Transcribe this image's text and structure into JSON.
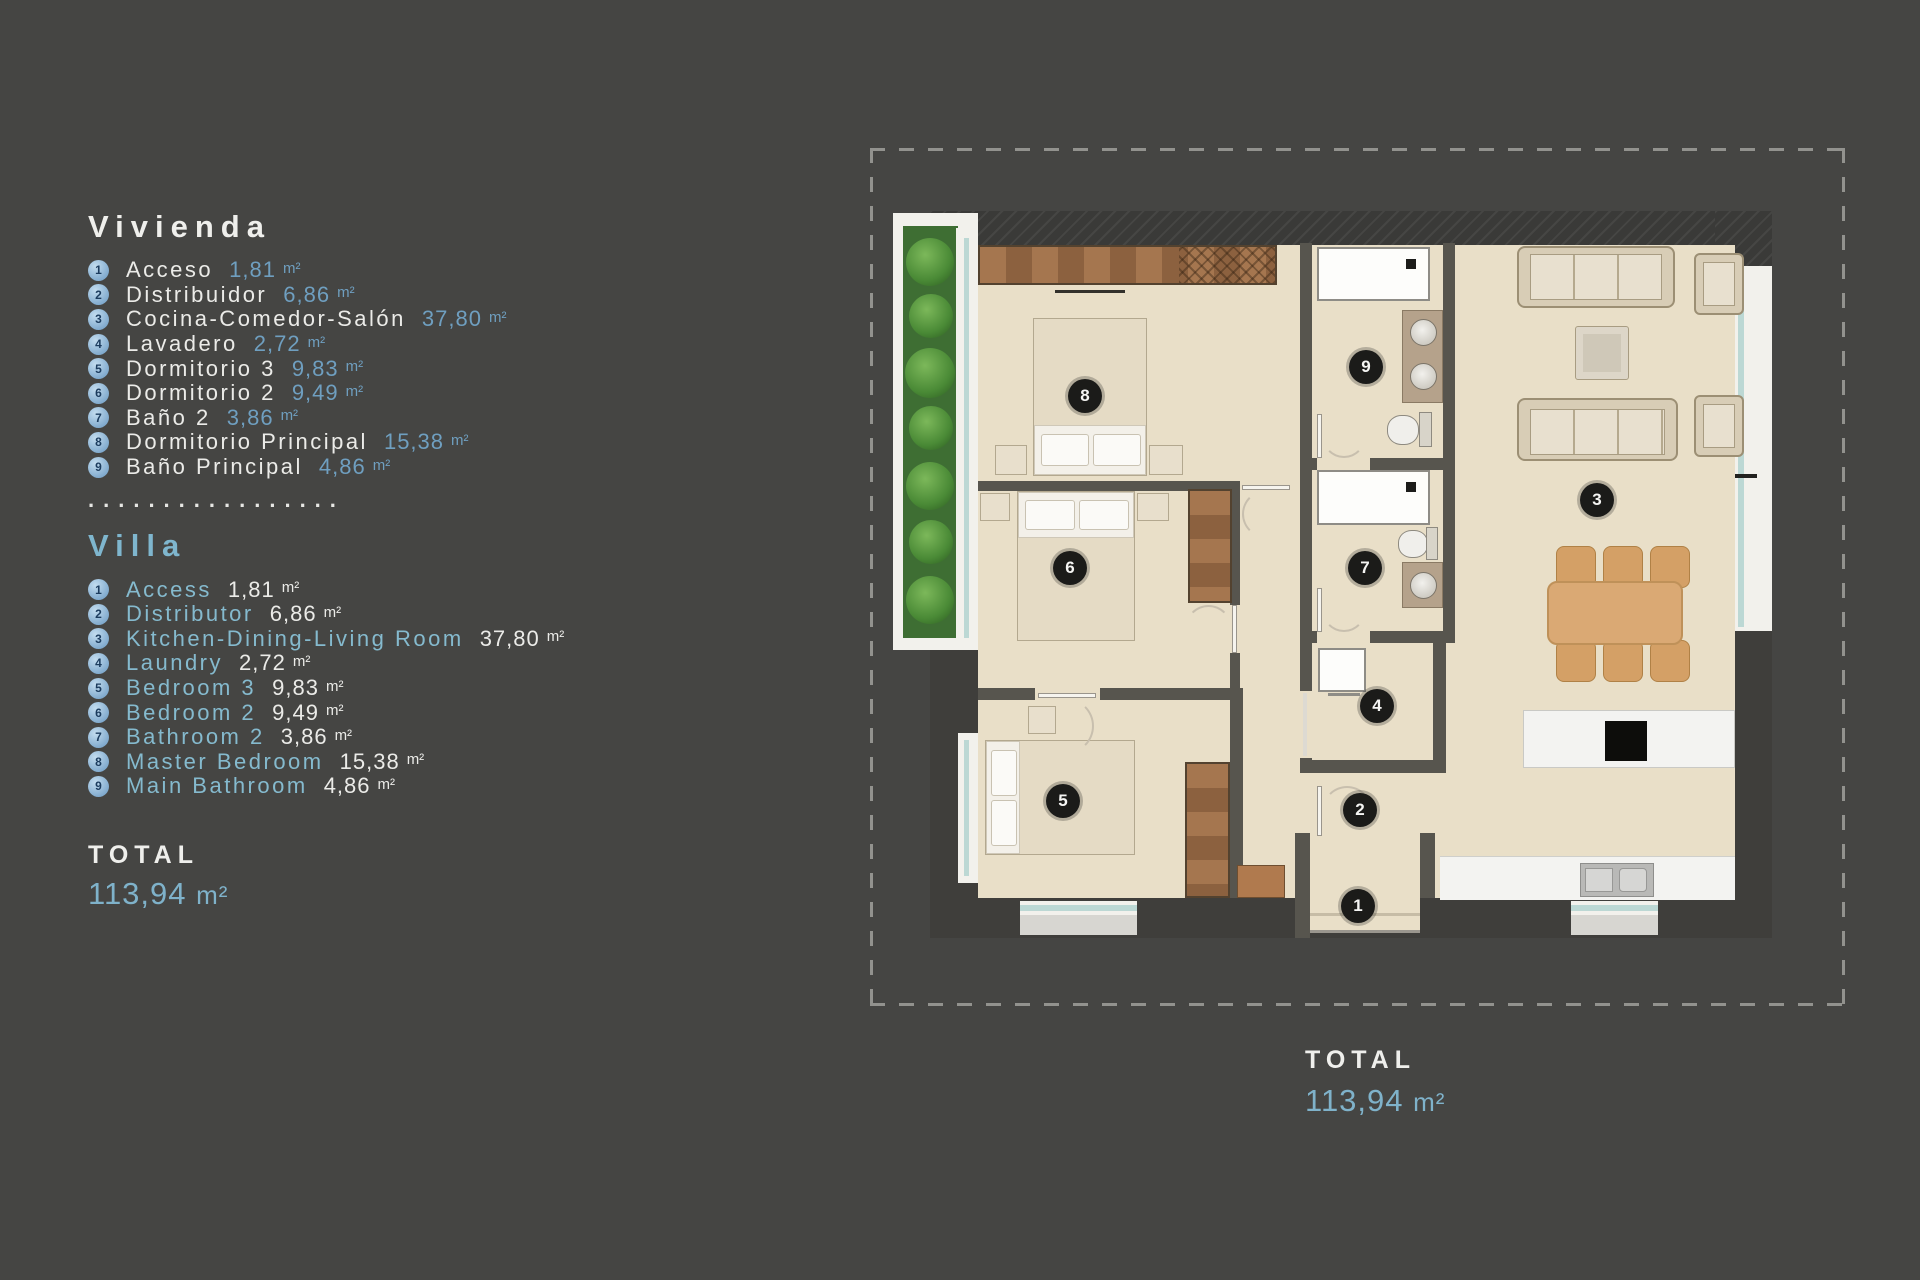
{
  "colors": {
    "background": "#454543",
    "accent_blue_values": "#6f9fc0",
    "accent_blue_villa": "#85bace",
    "total_blue": "#7fb2ca",
    "floor_beige": "#e9dfc8",
    "wall_dark": "#3f3e3b"
  },
  "legend": {
    "vivienda": {
      "title": "Vivienda",
      "items": [
        {
          "num": "1",
          "name": "Acceso",
          "value": "1,81",
          "unit": "m²"
        },
        {
          "num": "2",
          "name": "Distribuidor",
          "value": "6,86",
          "unit": "m²"
        },
        {
          "num": "3",
          "name": "Cocina-Comedor-Salón",
          "value": "37,80",
          "unit": "m²"
        },
        {
          "num": "4",
          "name": "Lavadero",
          "value": "2,72",
          "unit": "m²"
        },
        {
          "num": "5",
          "name": "Dormitorio 3",
          "value": "9,83",
          "unit": "m²"
        },
        {
          "num": "6",
          "name": "Dormitorio 2",
          "value": "9,49",
          "unit": "m²"
        },
        {
          "num": "7",
          "name": "Baño 2",
          "value": "3,86",
          "unit": "m²"
        },
        {
          "num": "8",
          "name": "Dormitorio Principal",
          "value": "15,38",
          "unit": "m²"
        },
        {
          "num": "9",
          "name": "Baño Principal",
          "value": "4,86",
          "unit": "m²"
        }
      ]
    },
    "separator": ".................",
    "villa": {
      "title": "Villa",
      "items": [
        {
          "num": "1",
          "name": "Access",
          "value": "1,81",
          "unit": "m²"
        },
        {
          "num": "2",
          "name": "Distributor",
          "value": "6,86",
          "unit": "m²"
        },
        {
          "num": "3",
          "name": "Kitchen-Dining-Living Room",
          "value": "37,80",
          "unit": "m²"
        },
        {
          "num": "4",
          "name": "Laundry",
          "value": "2,72",
          "unit": "m²"
        },
        {
          "num": "5",
          "name": "Bedroom 3",
          "value": "9,83",
          "unit": "m²"
        },
        {
          "num": "6",
          "name": "Bedroom 2",
          "value": "9,49",
          "unit": "m²"
        },
        {
          "num": "7",
          "name": "Bathroom 2",
          "value": "3,86",
          "unit": "m²"
        },
        {
          "num": "8",
          "name": "Master Bedroom",
          "value": "15,38",
          "unit": "m²"
        },
        {
          "num": "9",
          "name": "Main Bathroom",
          "value": "4,86",
          "unit": "m²"
        }
      ]
    },
    "total": {
      "label": "TOTAL",
      "value": "113,94",
      "unit": "m²"
    }
  },
  "plan": {
    "badges": [
      {
        "num": "1"
      },
      {
        "num": "2"
      },
      {
        "num": "3"
      },
      {
        "num": "4"
      },
      {
        "num": "5"
      },
      {
        "num": "6"
      },
      {
        "num": "7"
      },
      {
        "num": "8"
      },
      {
        "num": "9"
      }
    ],
    "total": {
      "label": "TOTAL",
      "value": "113,94",
      "unit": "m²"
    }
  }
}
